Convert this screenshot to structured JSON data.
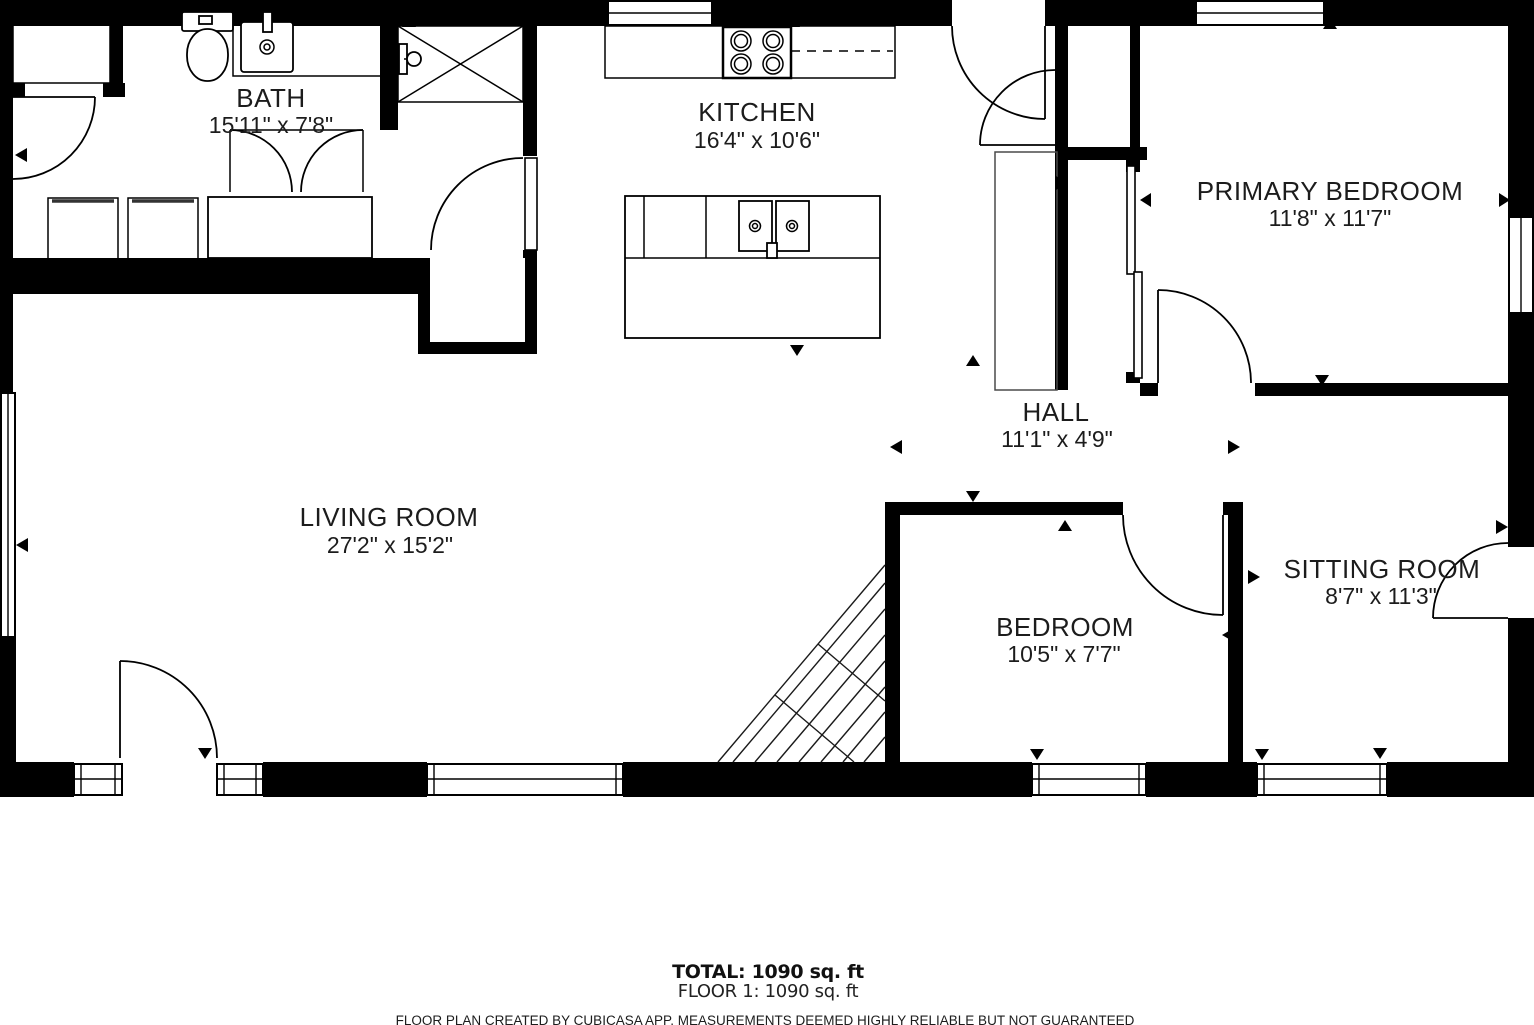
{
  "colors": {
    "wall": "#000000",
    "background": "#ffffff",
    "label": "#1c1c1c"
  },
  "rooms": [
    {
      "id": "bath",
      "name": "BATH",
      "dims": "15'11\" x 7'8\""
    },
    {
      "id": "kitchen",
      "name": "KITCHEN",
      "dims": "16'4\" x 10'6\""
    },
    {
      "id": "primary-bedroom",
      "name": "PRIMARY BEDROOM",
      "dims": "11'8\" x 11'7\""
    },
    {
      "id": "hall",
      "name": "HALL",
      "dims": "11'1\" x 4'9\""
    },
    {
      "id": "living-room",
      "name": "LIVING ROOM",
      "dims": "27'2\" x 15'2\""
    },
    {
      "id": "bedroom",
      "name": "BEDROOM",
      "dims": "10'5\" x 7'7\""
    },
    {
      "id": "sitting-room",
      "name": "SITTING ROOM",
      "dims": "8'7\" x 11'3\""
    }
  ],
  "footer": {
    "total": "TOTAL: 1090 sq. ft",
    "floor": "FLOOR 1: 1090 sq. ft",
    "disclaimer": "FLOOR PLAN CREATED BY CUBICASA APP. MEASUREMENTS DEEMED HIGHLY RELIABLE BUT NOT GUARANTEED"
  }
}
